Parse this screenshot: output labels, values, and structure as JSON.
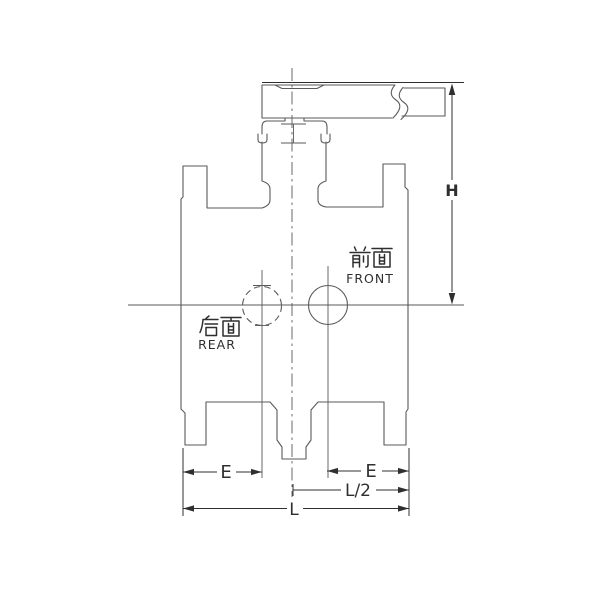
{
  "labels": {
    "front": {
      "zh": "前面",
      "en": "FRONT"
    },
    "rear": {
      "zh": "后面",
      "en": "REAR"
    }
  },
  "dimensions": {
    "h": "H",
    "e": "E",
    "l_half": "L/2",
    "l": "L"
  },
  "colors": {
    "line": "#5a5a5a",
    "dim": "#2f2f2f",
    "background": "#ffffff"
  }
}
